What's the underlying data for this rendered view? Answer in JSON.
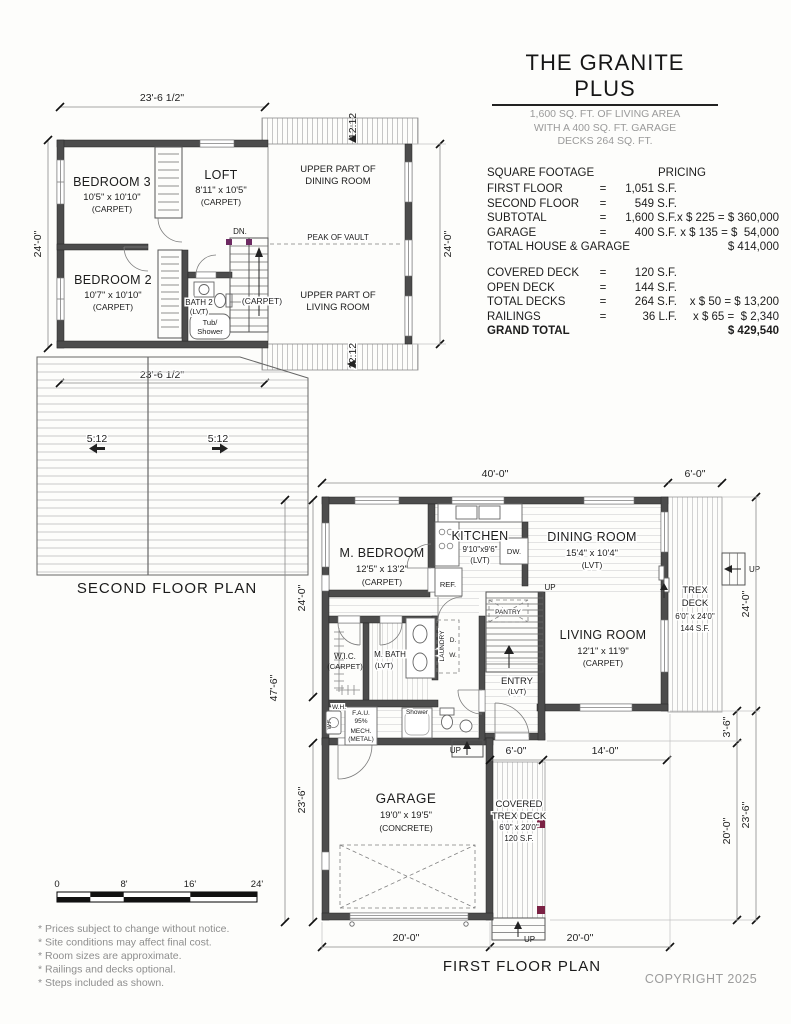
{
  "header": {
    "title": "THE GRANITE PLUS",
    "sub1": "1,600 SQ. FT. OF LIVING AREA",
    "sub2": "WITH A 400 SQ. FT. GARAGE",
    "sub3": "DECKS 264 SQ. FT."
  },
  "pricing": {
    "col1": "SQUARE FOOTAGE",
    "col2": "PRICING",
    "rows": [
      {
        "label": "FIRST FLOOR",
        "eq": "=",
        "value": "1,051 S.F.",
        "calc": ""
      },
      {
        "label": "SECOND FLOOR",
        "eq": "=",
        "value": "549 S.F.",
        "calc": ""
      },
      {
        "label": "SUBTOTAL",
        "eq": "=",
        "value": "1,600 S.F.",
        "calc": "x $ 225 = $ 360,000"
      },
      {
        "label": "GARAGE",
        "eq": "=",
        "value": "400 S.F.",
        "calc": "x $ 135 = $  54,000"
      },
      {
        "label": "TOTAL HOUSE & GARAGE",
        "eq": "",
        "value": "",
        "calc": "$ 414,000"
      },
      {
        "label": "COVERED DECK",
        "eq": "=",
        "value": "120 S.F.",
        "calc": ""
      },
      {
        "label": "OPEN DECK",
        "eq": "=",
        "value": "144 S.F.",
        "calc": ""
      },
      {
        "label": "TOTAL DECKS",
        "eq": "=",
        "value": "264 S.F.",
        "calc": "x $ 50 = $ 13,200"
      },
      {
        "label": "RAILINGS",
        "eq": "=",
        "value": "36 L.F.",
        "calc": "x $ 65 =  $ 2,340"
      },
      {
        "label": "GRAND TOTAL",
        "eq": "",
        "value": "",
        "calc": "$ 429,540"
      }
    ]
  },
  "second_floor": {
    "title": "SECOND FLOOR PLAN",
    "dims": {
      "top": "23'-6 1/2\"",
      "bottom": "23'-6 1/2\"",
      "left": "24'-0\"",
      "right": "24'-0\"",
      "slope_top": "12:12",
      "slope_bottom": "12:12",
      "roof_slope_l": "5:12",
      "roof_slope_r": "5:12"
    },
    "rooms": {
      "bedroom3": {
        "name": "BEDROOM 3",
        "size": "10'5\" x 10'10\"",
        "floor": "(CARPET)"
      },
      "loft": {
        "name": "LOFT",
        "size": "8'11\" x 10'5\"",
        "floor": "(CARPET)"
      },
      "bedroom2": {
        "name": "BEDROOM 2",
        "size": "10'7\" x 10'10\"",
        "floor": "(CARPET)"
      },
      "bath2": {
        "name": "BATH 2",
        "floor": "(LVT)",
        "tub1": "Tub/",
        "tub2": "Shower"
      },
      "stairs": {
        "dn": "DN.",
        "floor": "(CARPET)"
      },
      "upper_dining": {
        "l1": "UPPER PART OF",
        "l2": "DINING ROOM"
      },
      "peak": "PEAK OF VAULT",
      "upper_living": {
        "l1": "UPPER PART OF",
        "l2": "LIVING ROOM"
      }
    }
  },
  "first_floor": {
    "title": "FIRST FLOOR PLAN",
    "up": "UP",
    "dims": {
      "top": "40'-0\"",
      "deck_top": "6'-0\"",
      "left_upper": "24'-0\"",
      "left_outer": "47'-6\"",
      "left_lower": "23'-6\"",
      "right_upper": "24'-0\"",
      "right_36": "3'-6\"",
      "right_lower": "20'-0\"",
      "right_outer": "23'-6\"",
      "mid_6": "6'-0\"",
      "mid_14": "14'-0\"",
      "bottom_garage": "20'-0\"",
      "bottom_right": "20'-0\""
    },
    "rooms": {
      "m_bedroom": {
        "name": "M. BEDROOM",
        "size": "12'5\" x 13'2\"",
        "floor": "(CARPET)"
      },
      "kitchen": {
        "name": "KITCHEN",
        "size": "9'10\"x9'6\"",
        "floor": "(LVT)",
        "dw": "DW.",
        "ref": "REF."
      },
      "dining": {
        "name": "DINING ROOM",
        "size": "15'4\" x 10'4\"",
        "floor": "(LVT)"
      },
      "living": {
        "name": "LIVING ROOM",
        "size": "12'1\" x 11'9\"",
        "floor": "(CARPET)"
      },
      "wic": {
        "name": "W.I.C.",
        "floor": "(CARPET)"
      },
      "m_bath": {
        "name": "M. BATH",
        "floor": "(LVT)"
      },
      "laundry": {
        "name": "LAUNDRY",
        "d": "D.",
        "w": "W."
      },
      "entry": {
        "name": "ENTRY",
        "floor": "(LVT)"
      },
      "pantry": "PANTRY",
      "mech": {
        "wh": "W.H.",
        "fau": "F.A.U.",
        "pct": "95%",
        "mech": "MECH.",
        "metal": "(METAL)",
        "wf": "W.F.",
        "shower": "Shower"
      },
      "trex_deck": {
        "l1": "TREX",
        "l2": "DECK",
        "size": "6'0\" x 24'0\"",
        "area": "144 S.F."
      },
      "garage": {
        "name": "GARAGE",
        "size": "19'0\" x 19'5\"",
        "floor": "(CONCRETE)"
      },
      "covered_deck": {
        "l1": "COVERED",
        "l2": "TREX DECK",
        "size": "6'0\" x 20'0\"",
        "area": "120 S.F."
      }
    }
  },
  "scale_bar": {
    "t0": "0",
    "t8": "8'",
    "t16": "16'",
    "t24": "24'"
  },
  "notes": [
    "* Prices subject to change without notice.",
    "* Site conditions may affect final cost.",
    "* Room sizes are approximate.",
    "* Railings and decks optional.",
    "* Steps included as shown."
  ],
  "copyright": "COPYRIGHT 2025"
}
